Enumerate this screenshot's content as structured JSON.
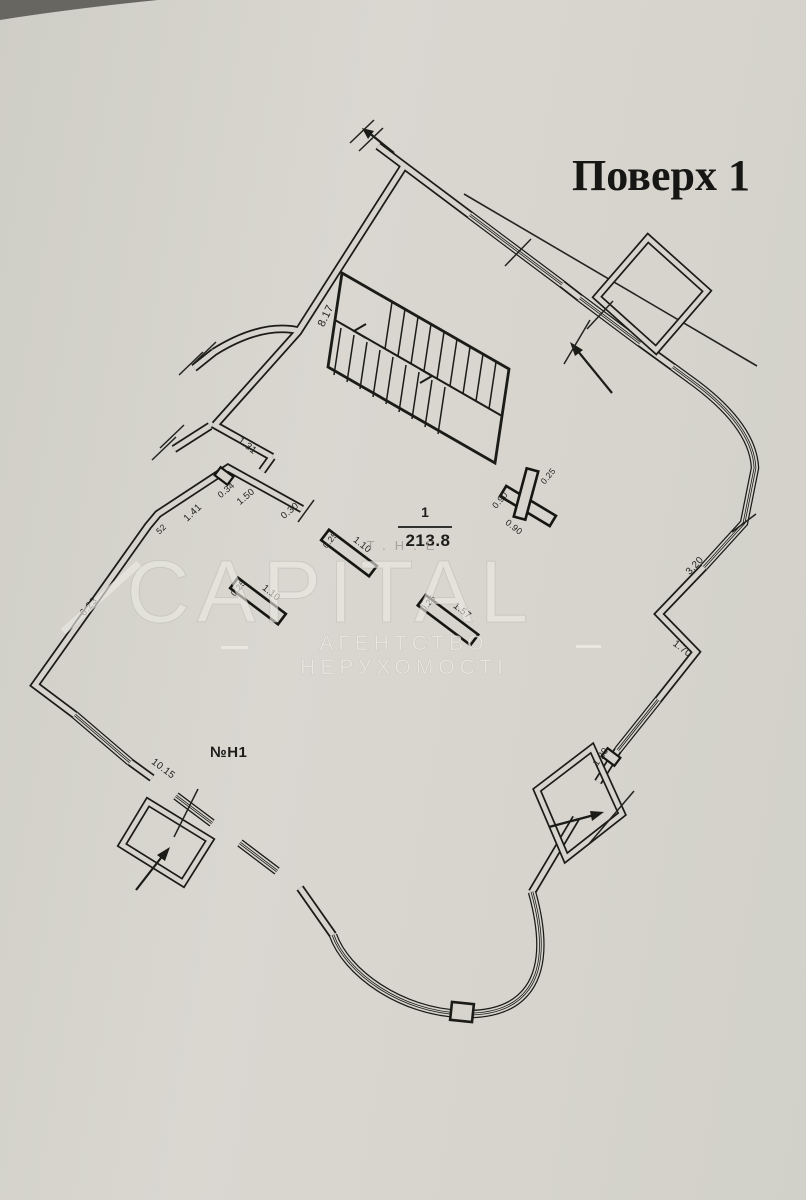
{
  "title": {
    "text": "Поверх 1"
  },
  "room": {
    "number": "1",
    "area": "213.8",
    "unit": "№Н1"
  },
  "watermark": {
    "top": "T.H.E",
    "brand": "CAPITAL",
    "tagline": "АГЕНТСТВО НЕРУХОМОСТІ"
  },
  "colors": {
    "ink": "#1d1d1b",
    "paper": "#d6d4cc",
    "watermark": "#e9e7df"
  },
  "dimensions": [
    {
      "text": "8.17",
      "x": 326,
      "y": 316,
      "rot": -64,
      "size": 11
    },
    {
      "text": "1.31",
      "x": 247,
      "y": 446,
      "rot": 38,
      "size": 10
    },
    {
      "text": "0.34",
      "x": 226,
      "y": 490,
      "rot": -40,
      "size": 9
    },
    {
      "text": "1.50",
      "x": 246,
      "y": 497,
      "rot": -40,
      "size": 9.5
    },
    {
      "text": "0.30",
      "x": 290,
      "y": 511,
      "rot": -40,
      "size": 9.5
    },
    {
      "text": "1.41",
      "x": 193,
      "y": 513,
      "rot": -44,
      "size": 10
    },
    {
      "text": "52",
      "x": 161,
      "y": 529,
      "rot": -44,
      "size": 8.5
    },
    {
      "text": "6.23",
      "x": 89,
      "y": 607,
      "rot": -49,
      "size": 10
    },
    {
      "text": "10.15",
      "x": 163,
      "y": 769,
      "rot": 37,
      "size": 10
    },
    {
      "text": "3.20",
      "x": 695,
      "y": 566,
      "rot": -47,
      "size": 10
    },
    {
      "text": "1.70",
      "x": 682,
      "y": 649,
      "rot": 37,
      "size": 10
    },
    {
      "text": "1.20",
      "x": 601,
      "y": 757,
      "rot": -55,
      "size": 9.5
    },
    {
      "text": "1.10",
      "x": 362,
      "y": 545,
      "rot": 38,
      "size": 9.5
    },
    {
      "text": "0.25",
      "x": 330,
      "y": 540,
      "rot": -50,
      "size": 8.5
    },
    {
      "text": "1.10",
      "x": 271,
      "y": 593,
      "rot": 38,
      "size": 9.5
    },
    {
      "text": "0.25",
      "x": 238,
      "y": 588,
      "rot": -50,
      "size": 8.5
    },
    {
      "text": "1.57",
      "x": 462,
      "y": 611,
      "rot": 38,
      "size": 9.5
    },
    {
      "text": "0.25",
      "x": 428,
      "y": 603,
      "rot": -50,
      "size": 8.5
    },
    {
      "text": "0.90",
      "x": 500,
      "y": 500,
      "rot": -50,
      "size": 9
    },
    {
      "text": "0.90",
      "x": 514,
      "y": 527,
      "rot": 38,
      "size": 9
    },
    {
      "text": "0.25",
      "x": 548,
      "y": 476,
      "rot": -50,
      "size": 8.5
    }
  ]
}
